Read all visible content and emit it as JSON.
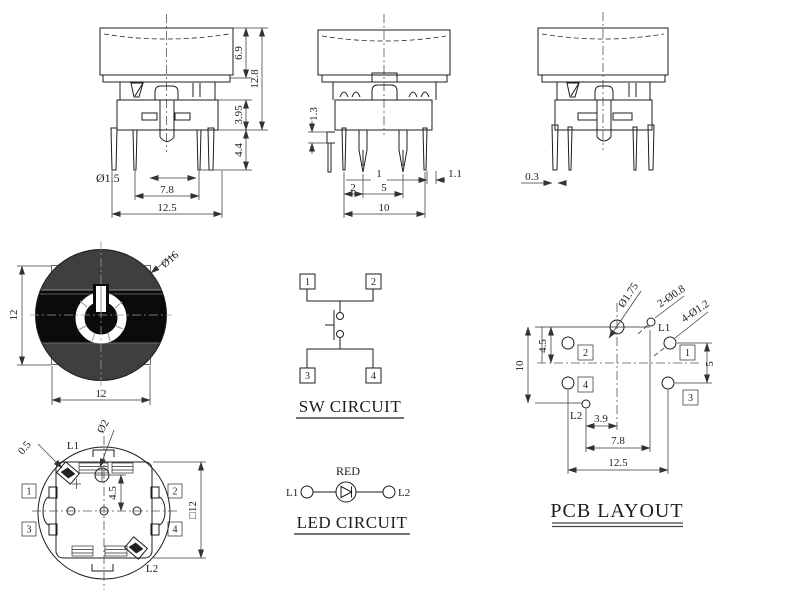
{
  "drawing": {
    "type": "illuminated tact switch technical drawing",
    "line_color": "#1c1c1c",
    "cap_black": "#0b0b0b",
    "cap_gray": "#3f3f42"
  },
  "side_view_left": {
    "dim_cap_height": "6.9",
    "dim_overall_height": "12.8",
    "dim_body_height": "3.95",
    "dim_pin_length": "4.4",
    "dim_pin_dia": "Ø1.5",
    "dim_inner_pin_span": "7.8",
    "dim_outer_pin_span": "12.5"
  },
  "side_view_middle": {
    "dim_step": "1.3",
    "dim_pin_width": "1",
    "dim_pin_tip": "1.1",
    "dim_led_pin_offset": "2",
    "dim_led_pin_span": "5",
    "dim_pin_span": "10"
  },
  "side_view_right": {
    "dim_leg_thickness": "0.3"
  },
  "front_view": {
    "dim_cap_dia": "Ø16",
    "dim_height": "12",
    "dim_width": "12"
  },
  "sw_circuit": {
    "title": "SW CIRCUIT",
    "pin1": "1",
    "pin2": "2",
    "pin3": "3",
    "pin4": "4"
  },
  "bottom_view": {
    "dim_slot": "0.5",
    "dim_post_dia": "Ø2",
    "dim_center_offset": "4.5",
    "dim_body_size": "□12",
    "led1": "L1",
    "led2": "L2",
    "pin1": "1",
    "pin2": "2",
    "pin3": "3",
    "pin4": "4"
  },
  "led_circuit": {
    "title": "LED CIRCUIT",
    "led_color": "RED",
    "led1": "L1",
    "led2": "L2"
  },
  "pcb_layout": {
    "title": "PCB LAYOUT",
    "dim_center_hole": "Ø1.75",
    "dim_led_holes": "2-Ø0.8",
    "dim_pin_holes": "4-Ø1.2",
    "led1": "L1",
    "led2": "L2",
    "pin1": "1",
    "pin2": "2",
    "pin3": "3",
    "pin4": "4",
    "dim_v_overall": "10",
    "dim_v_top": "4.5",
    "dim_v_pins": "5",
    "dim_l2_offset": "3.9",
    "dim_led_span": "7.8",
    "dim_h_overall": "12.5"
  }
}
